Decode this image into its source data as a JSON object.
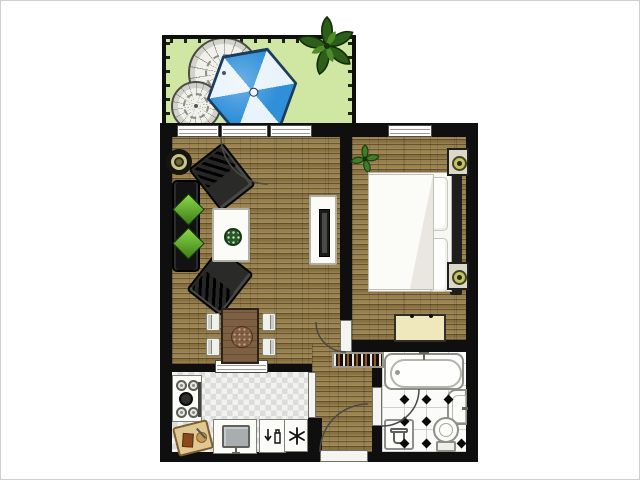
{
  "scene": {
    "type": "apartment-floor-plan",
    "description": "Top-down floor plan of a one-bedroom apartment with terrace"
  },
  "colors": {
    "wall": "#0f0f0f",
    "wood": "#96804f",
    "tile-light": "#f2f2f0",
    "tile-dark": "#dcdcda",
    "terrace-green": "#cfe7a3",
    "umbrella-blue": "#2f8fd9",
    "umbrella-pale": "#e9f3fb",
    "umbrella-edge": "#1c3c5e",
    "leaf-green": "#2d5e1a",
    "cushion-green": "#8bd84a",
    "table-wood": "#7d5f43",
    "centerpiece-red": "#8e2a1a",
    "bench-cream": "#efe8bd",
    "lamp-olive": "#c2c266",
    "fixture-border": "#8f8f8a",
    "bath-grid": "#cfcfd4"
  },
  "rooms": {
    "terrace": {
      "label": "Terrace",
      "items": [
        "stone mosaic circle large",
        "stone mosaic circle small",
        "parasol",
        "potted plant"
      ]
    },
    "living_room": {
      "label": "Living room",
      "items": [
        "sofa with two green cushions",
        "round side table",
        "armchair upper",
        "armchair lower",
        "coffee table with plant",
        "TV cabinet",
        "dining table with centerpiece",
        "4 dining chairs"
      ]
    },
    "bedroom": {
      "label": "Bedroom",
      "items": [
        "double bed with duvet",
        "two pillows",
        "headboard",
        "nightstand with lamp x2",
        "bench",
        "plant"
      ]
    },
    "kitchen": {
      "label": "Kitchen",
      "items": [
        "stove with pot",
        "cutting board",
        "sink",
        "dishwasher",
        "freezer",
        "pass-through window"
      ]
    },
    "bathroom": {
      "label": "Bathroom",
      "items": [
        "bathtub",
        "washbasin",
        "toilet",
        "laundry basket",
        "diamond tile floor"
      ]
    },
    "hallway": {
      "label": "Hallway",
      "items": [
        "shoe rack",
        "entry door"
      ]
    }
  },
  "labels": {
    "terrace": "Terrace",
    "living_room": "Living room",
    "bedroom": "Bedroom",
    "kitchen": "Kitchen",
    "bathroom": "Bathroom",
    "hallway": "Hallway",
    "parasol": "Parasol",
    "stone_circle": "Stone mosaic circle",
    "plant": "Plant",
    "sofa": "Sofa",
    "side_table": "Round side table",
    "armchair": "Armchair",
    "coffee_table": "Coffee table",
    "tv_cabinet": "TV cabinet",
    "dining_table": "Dining table",
    "dining_chair": "Dining chair",
    "bed": "Double bed",
    "pillow": "Pillow",
    "nightstand": "Nightstand with lamp",
    "bench": "Bench",
    "stove": "Stove",
    "cutting_board": "Cutting board",
    "kitchen_sink": "Kitchen sink",
    "dishwasher": "Dishwasher",
    "freezer": "Freezer",
    "bathtub": "Bathtub",
    "washbasin": "Washbasin",
    "toilet": "Toilet",
    "laundry_basket": "Laundry basket",
    "shoe_rack": "Shoe rack",
    "window": "Window",
    "door": "Door swing",
    "entry_door": "Entry door"
  },
  "counts": {
    "windows": 4,
    "doors": 4,
    "dining_chairs": 4,
    "bathroom_diamonds": 8
  }
}
